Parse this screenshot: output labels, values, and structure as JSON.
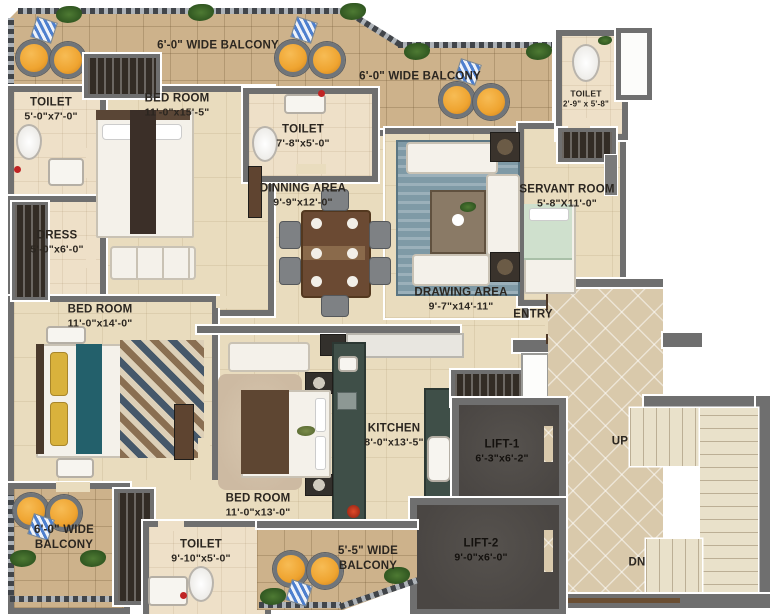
{
  "colors": {
    "wall": "#6f6f6f",
    "floor": "#e9dcbe",
    "tfloor": "#eee0c8",
    "balcony": "#cdb28b",
    "lobby": "#d9c9ab",
    "lift": "#4a4643",
    "stairs": "#e9e1ca",
    "pouf": "#efa430",
    "wood": "#6b4a33",
    "counter": "#3f4f48",
    "txt": "#2b2620"
  },
  "rooms": {
    "balcony_top_left": {
      "name": "6'-0\" WIDE BALCONY"
    },
    "balcony_top_right": {
      "name": "6'-0\" WIDE BALCONY"
    },
    "toilet_top_left": {
      "name": "TOILET",
      "dims": "5'-0\"x7'-0\""
    },
    "bedroom_top": {
      "name": "BED ROOM",
      "dims": "11'-0\"x15'-5\""
    },
    "toilet_mid": {
      "name": "TOILET",
      "dims": "7'-8\"x5'-0\""
    },
    "toilet_top_right": {
      "name": "TOILET",
      "dims": "2'-9\" x 5'-8\""
    },
    "dress": {
      "name": "DRESS",
      "dims": "5'-0\"x6'-0\""
    },
    "dinning": {
      "name": "DINNING AREA",
      "dims": "9'-9\"x12'-0\""
    },
    "drawing": {
      "name": "DRAWING AREA",
      "dims": "9'-7\"x14'-11\""
    },
    "servant": {
      "name": "SERVANT ROOM",
      "dims": "5'-8\"X11'-0\""
    },
    "entry": {
      "name": "ENTRY"
    },
    "bedroom_left": {
      "name": "BED ROOM",
      "dims": "11'-0\"x14'-0\""
    },
    "kitchen": {
      "name": "KITCHEN",
      "dims": "8'-0\"x13'-5\""
    },
    "bedroom_bottom": {
      "name": "BED ROOM",
      "dims": "11'-0\"x13'-0\""
    },
    "lift1": {
      "name": "LIFT-1",
      "dims": "6'-3\"x6'-2\""
    },
    "lift2": {
      "name": "LIFT-2",
      "dims": "9'-0\"x6'-0\""
    },
    "balcony_bottom_left": {
      "line1": "6'-0\" WIDE",
      "line2": "BALCONY"
    },
    "toilet_bottom": {
      "name": "TOILET",
      "dims": "9'-10\"x5'-0\""
    },
    "balcony_bottom": {
      "line1": "5'-5\" WIDE",
      "line2": "BALCONY"
    },
    "stairs_up": {
      "name": "UP"
    },
    "stairs_dn": {
      "name": "DN"
    }
  }
}
